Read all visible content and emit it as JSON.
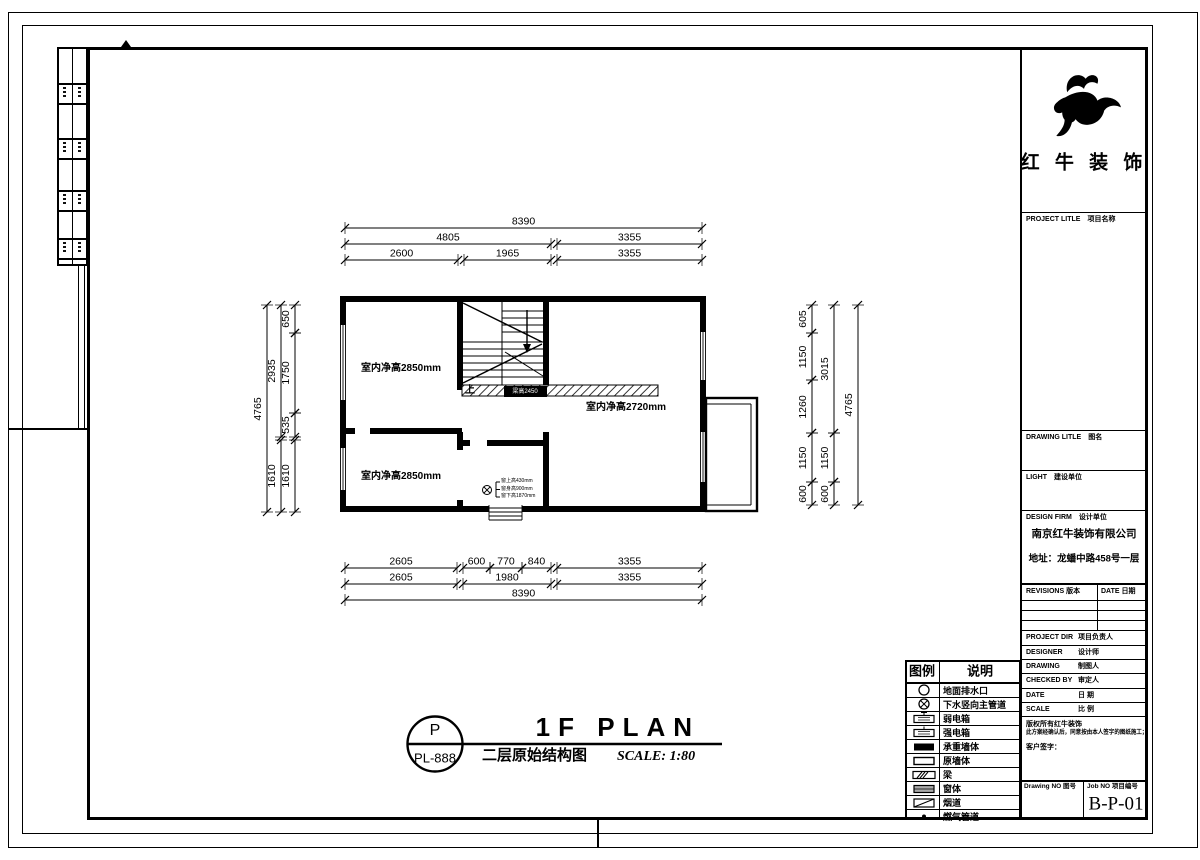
{
  "title_block": {
    "company": "红 牛 装 饰",
    "project_title_label": "PROJECT LITLE　项目名称",
    "drawing_title_label": "DRAWING LITLE　图名",
    "client_label": "LIGHT　建设单位",
    "design_firm_label": "DESIGN FIRM　设计单位",
    "firm_name": "南京红牛装饰有限公司",
    "firm_address": "地址：龙蟠中路458号一层",
    "revisions_label": "REVISIONS 版本",
    "date_col_label": "DATE 日期",
    "fields": [
      {
        "en": "PROJECT DIR",
        "zh": "项目负责人"
      },
      {
        "en": "DESIGNER",
        "zh": "设计师"
      },
      {
        "en": "DRAWING",
        "zh": "制图人"
      },
      {
        "en": "CHECKED BY",
        "zh": "审定人"
      },
      {
        "en": "DATE",
        "zh": "日  期"
      },
      {
        "en": "SCALE",
        "zh": "比  例"
      }
    ],
    "notes_line1": "版权所有红牛装饰",
    "notes_line2": "此方案经确认后，同意按由本人签字的图纸施工；",
    "notes_line3": "客户签字：",
    "drawing_no_label": "Drawing NO 图号",
    "job_no_label": "Job NO 项目编号",
    "job_no": "B-P-01"
  },
  "legend": {
    "header_symbol": "图例",
    "header_desc": "说明",
    "rows": [
      {
        "icon": "drain-circle-icon",
        "label": "地面排水口"
      },
      {
        "icon": "drain-pipe-icon",
        "label": "下水竖向主管道"
      },
      {
        "icon": "weak-current-box-icon",
        "label": "弱电箱"
      },
      {
        "icon": "strong-current-box-icon",
        "label": "强电箱"
      },
      {
        "icon": "bearing-wall-icon",
        "label": "承重墙体"
      },
      {
        "icon": "original-wall-icon",
        "label": "原墙体"
      },
      {
        "icon": "beam-icon",
        "label": "梁"
      },
      {
        "icon": "window-icon",
        "label": "窗体"
      },
      {
        "icon": "flue-icon",
        "label": "烟道"
      },
      {
        "icon": "gas-pipe-icon",
        "label": "燃气管道"
      }
    ]
  },
  "plan": {
    "rooms": [
      {
        "label": "室内净高2850mm"
      },
      {
        "label": "室内净高2850mm"
      },
      {
        "label": "室内净高2720mm"
      }
    ],
    "stair_up_label": "上",
    "beam_tag": "梁高2450",
    "window_notes": [
      "窗上高430mm",
      "窗身高900mm",
      "窗下高1870mm"
    ],
    "dims_top": [
      "8390",
      "4805",
      "3355",
      "2600",
      "1965",
      "3355"
    ],
    "dims_bottom": [
      "2605",
      "600",
      "770",
      "840",
      "3355",
      "2605",
      "1980",
      "3355",
      "8390"
    ],
    "dims_left": [
      "4765",
      "2935",
      "1610",
      "650",
      "1750",
      "535",
      "1610"
    ],
    "dims_right": [
      "605",
      "1150",
      "1260",
      "1150",
      "600",
      "3015",
      "1150",
      "600",
      "4765"
    ]
  },
  "caption": {
    "tag_top": "P",
    "tag_bottom": "PL-888",
    "title_en": "1F PLAN",
    "title_zh": "二层原始结构图",
    "scale": "SCALE: 1:80"
  }
}
